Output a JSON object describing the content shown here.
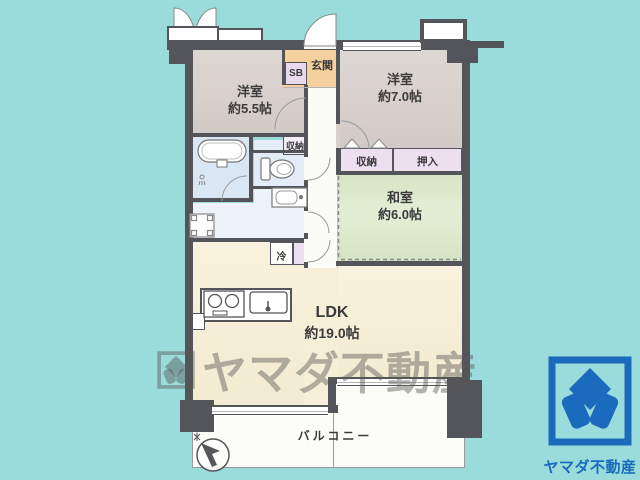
{
  "rooms": {
    "western1": {
      "name": "洋室",
      "size": "約5.5帖"
    },
    "western2": {
      "name": "洋室",
      "size": "約7.0帖"
    },
    "tatami": {
      "name": "和室",
      "size": "約6.0帖"
    },
    "ldk": {
      "name": "LDK",
      "size": "約19.0帖"
    }
  },
  "labels": {
    "entrance": "玄関",
    "shoebox": "SB",
    "storage_hall": "収納",
    "storage_west": "収納",
    "oshiire": "押入",
    "fridge": "冷",
    "balcony": "バルコニー"
  },
  "watermark": {
    "text": "ヤマダ不動産"
  },
  "brand": {
    "name": "ヤマダ不動産"
  },
  "colors": {
    "background": "#9adbdb",
    "wall": "#54555a",
    "western_room": "#d7d0cb",
    "entrance": "#f6cf9e",
    "closet": "#ecdff0",
    "bath": "#d9e6f3",
    "tatami": "#dbe8cb",
    "ldk": "#f6efd8",
    "balcony": "#fcfcf9",
    "logo_blue": "#1a6bbd"
  }
}
